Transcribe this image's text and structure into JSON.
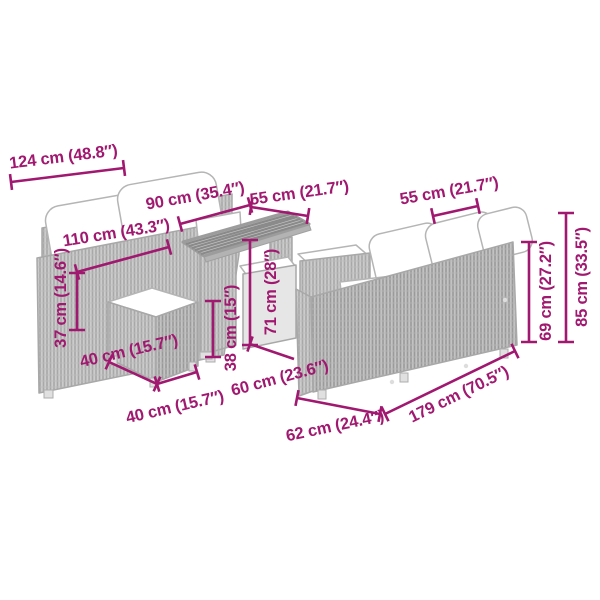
{
  "diagram": {
    "type": "product-dimension-diagram",
    "subject": "poly-rattan garden lounge set: 2-seater sofa, 3-seater sofa, table and cushioned stools",
    "unit_format": "cm (inches)",
    "accent_color": "#A0186F",
    "furniture_colors": {
      "rattan_fill": "#cccccc",
      "rattan_weave": "#a8a8a8",
      "cushion": "#ffffff",
      "outline": "#a8a8a8"
    },
    "annotations": [
      {
        "id": "sofa-left-total-width",
        "label": "124 cm (48.8″)",
        "line": [
          11,
          182,
          124,
          168
        ],
        "text": [
          64,
          162
        ],
        "rot": -7
      },
      {
        "id": "sofa-left-seat-width",
        "label": "110 cm (43.3″)",
        "line": [
          77,
          272,
          169,
          247
        ],
        "text": [
          117,
          238
        ],
        "rot": -9
      },
      {
        "id": "sofa-left-seat-height",
        "label": "37 cm (14.6″)",
        "line": [
          77,
          273,
          77,
          330
        ],
        "text": [
          66,
          298
        ],
        "rot": -90
      },
      {
        "id": "table-length",
        "label": "90 cm (35.4″)",
        "line": [
          180,
          224,
          250,
          205
        ],
        "text": [
          196,
          201
        ],
        "rot": -10
      },
      {
        "id": "table-depth",
        "label": "55 cm (21.7″)",
        "line": [
          251,
          207,
          308,
          216
        ],
        "text": [
          300,
          198
        ],
        "rot": -8
      },
      {
        "id": "sofa-right-seat-depth",
        "label": "55 cm (21.7″)",
        "line": [
          433,
          216,
          478,
          206
        ],
        "text": [
          450,
          196
        ],
        "rot": -10
      },
      {
        "id": "table-height",
        "label": "71 cm (28″)",
        "line": [
          250,
          240,
          250,
          345
        ],
        "text": [
          276,
          292
        ],
        "rot": -90
      },
      {
        "id": "stool-height",
        "label": "38 cm (15″)",
        "line": [
          213,
          301,
          213,
          357
        ],
        "text": [
          236,
          328
        ],
        "rot": -90
      },
      {
        "id": "stool-depth",
        "label": "40 cm (15.7″)",
        "line": [
          109,
          362,
          157,
          384
        ],
        "text": [
          130,
          356
        ],
        "rot": -13
      },
      {
        "id": "stool-width",
        "label": "40 cm (15.7″)",
        "line": [
          157,
          384,
          197,
          372
        ],
        "text": [
          176,
          412
        ],
        "rot": -13
      },
      {
        "id": "table-base-depth",
        "label": "60 cm (23.6″)",
        "line": [
          250,
          344,
          294,
          359
        ],
        "text": [
          281,
          383
        ],
        "rot": -15,
        "ticks": [
          true,
          false
        ]
      },
      {
        "id": "sofa-right-depth",
        "label": "62 cm (24.4″)",
        "line": [
          297,
          398,
          380,
          414
        ],
        "text": [
          336,
          431
        ],
        "rot": -12
      },
      {
        "id": "sofa-right-width",
        "label": "179 cm (70.5″)",
        "line": [
          385,
          414,
          515,
          351
        ],
        "text": [
          461,
          399
        ],
        "rot": -26
      },
      {
        "id": "sofa-right-back-height",
        "label": "69 cm (27.2″)",
        "line": [
          529,
          242,
          529,
          342
        ],
        "text": [
          551,
          291
        ],
        "rot": -90
      },
      {
        "id": "sofa-right-total-height",
        "label": "85 cm (33.5″)",
        "line": [
          566,
          213,
          566,
          342
        ],
        "text": [
          587,
          277
        ],
        "rot": -90
      }
    ]
  }
}
